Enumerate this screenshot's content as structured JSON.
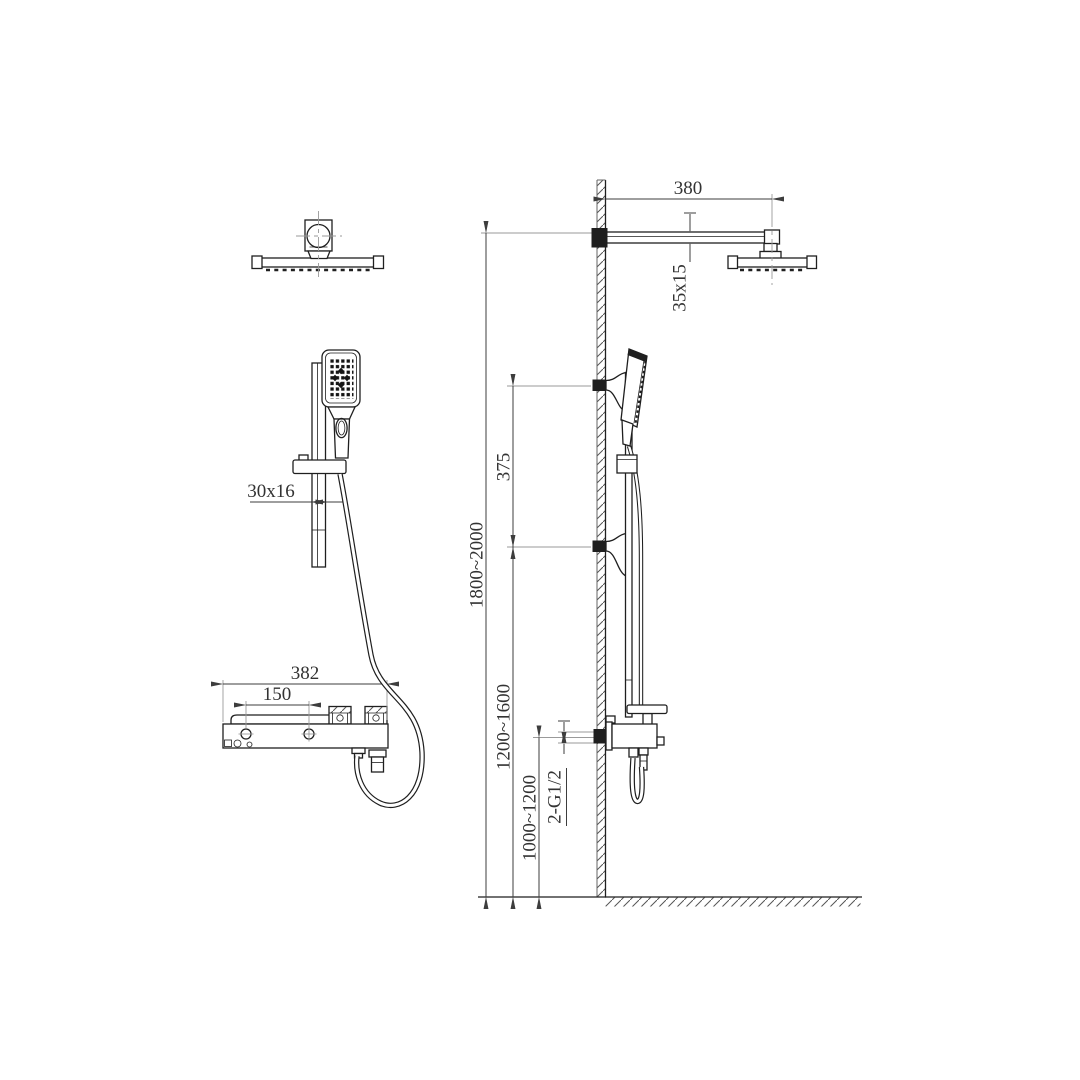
{
  "colors": {
    "background": "#ffffff",
    "line": "#1f1f1f",
    "dimension_text": "#333333",
    "dimension_line": "#3d3d3d",
    "centerline": "#9a9a9a"
  },
  "dimensions": {
    "front": {
      "bar_section": "30x16",
      "body_width": "382",
      "outlet_spacing": "150"
    },
    "side": {
      "arm_length": "380",
      "arm_section": "35x15",
      "bracket_spacing": "375",
      "overall_height": "1800~2000",
      "lower_bracket_height": "1200~1600",
      "inlet_height": "1000~1200",
      "inlet_connections": "2-G1/2"
    }
  }
}
